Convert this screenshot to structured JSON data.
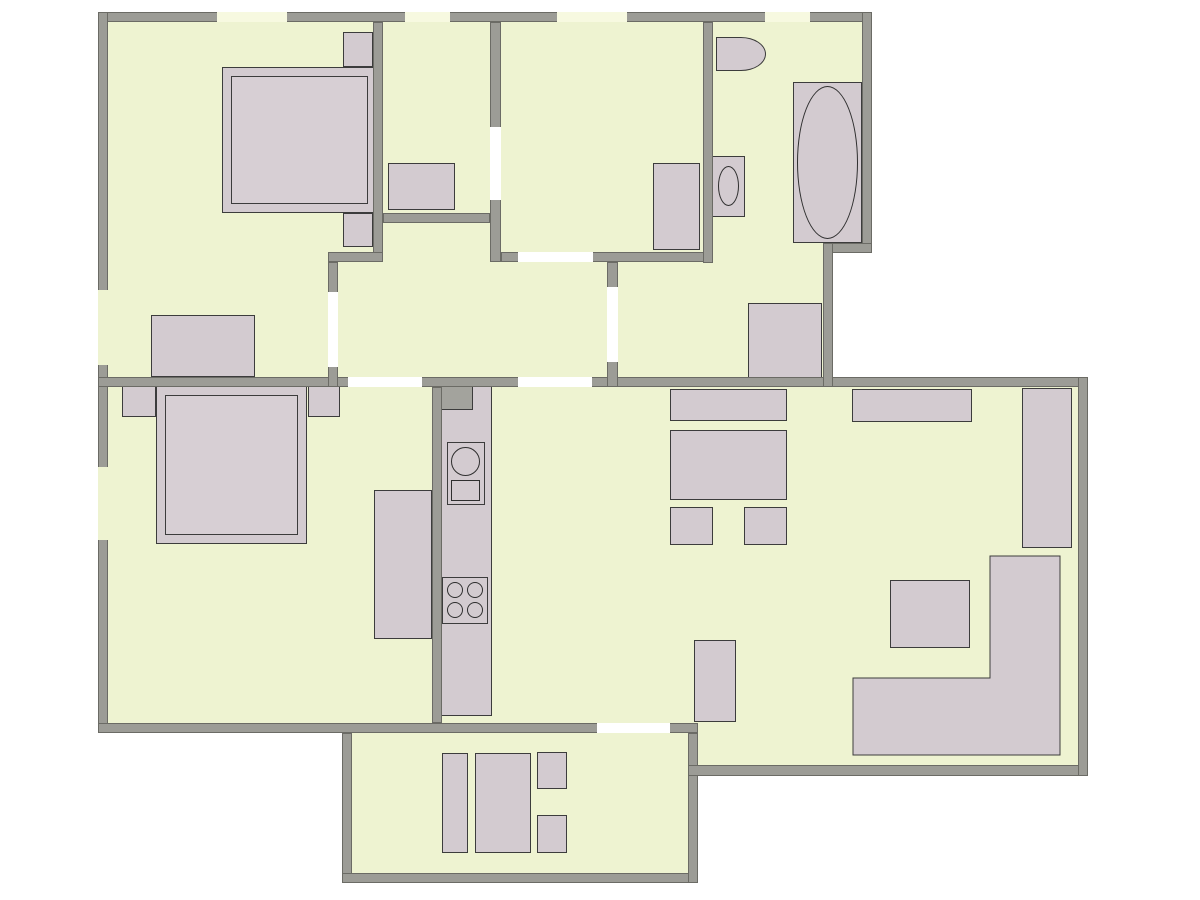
{
  "title": "apartment-floor-plan",
  "canvas": {
    "width": 1200,
    "height": 900
  },
  "colors": {
    "background": "#ffffff",
    "floor": "#eef3d1",
    "wall": "#9c9c96",
    "wall_edge": "#6b6b65",
    "furniture": "#d3cbd0",
    "bed_inner": "#d7cfd4",
    "shaft": "#a3a39d",
    "furniture_edge": "#3c3c3c",
    "fixture_line": "#2f2f2f",
    "window": "#f7f9e0",
    "door": "#ffffff"
  },
  "rooms": [
    {
      "name": "bedroom-top-left",
      "x": 108,
      "y": 22,
      "w": 265,
      "h": 355
    },
    {
      "name": "walk-in-closet",
      "x": 383,
      "y": 22,
      "w": 107,
      "h": 191
    },
    {
      "name": "middle-room",
      "x": 501,
      "y": 22,
      "w": 202,
      "h": 230
    },
    {
      "name": "bathroom",
      "x": 713,
      "y": 22,
      "w": 149,
      "h": 221
    },
    {
      "name": "hallway",
      "x": 338,
      "y": 223,
      "w": 269,
      "h": 154
    },
    {
      "name": "bathroom-corridor",
      "x": 618,
      "y": 263,
      "w": 205,
      "h": 114
    },
    {
      "name": "bedroom-bottom-left",
      "x": 108,
      "y": 387,
      "w": 324,
      "h": 336
    },
    {
      "name": "kitchen-strip",
      "x": 442,
      "y": 387,
      "w": 55,
      "h": 336
    },
    {
      "name": "living-dining-room",
      "x": 497,
      "y": 387,
      "w": 581,
      "h": 378
    },
    {
      "name": "balcony",
      "x": 352,
      "y": 733,
      "w": 336,
      "h": 140
    }
  ],
  "sofa": {
    "points": "990,556 1060,556 1060,755 853,755 853,678 990,678"
  },
  "layers": [
    {
      "name": "floors",
      "z": 0,
      "fill": "floor",
      "items": [
        {
          "name": "floor-top-band",
          "x": 108,
          "y": 22,
          "w": 754,
          "h": 221
        },
        {
          "name": "floor-mid-band",
          "x": 108,
          "y": 243,
          "w": 715,
          "h": 134
        },
        {
          "name": "floor-main",
          "x": 108,
          "y": 387,
          "w": 970,
          "h": 336
        },
        {
          "name": "floor-living-south",
          "x": 698,
          "y": 723,
          "w": 380,
          "h": 42
        },
        {
          "name": "floor-balcony",
          "x": 352,
          "y": 733,
          "w": 336,
          "h": 140
        }
      ]
    },
    {
      "name": "furniture",
      "z": 2,
      "fill": "furniture",
      "stroke": "furniture_edge",
      "items": [
        {
          "name": "bed-frame",
          "x": 222,
          "y": 67,
          "w": 155,
          "h": 146
        },
        {
          "name": "bed-mattress",
          "x": 231,
          "y": 76,
          "w": 137,
          "h": 128,
          "fill": "bed_inner"
        },
        {
          "name": "nightstand",
          "x": 343,
          "y": 32,
          "w": 30,
          "h": 35
        },
        {
          "name": "nightstand",
          "x": 343,
          "y": 213,
          "w": 30,
          "h": 34
        },
        {
          "name": "dresser",
          "x": 151,
          "y": 315,
          "w": 104,
          "h": 62
        },
        {
          "name": "closet-dresser",
          "x": 388,
          "y": 163,
          "w": 67,
          "h": 47
        },
        {
          "name": "wardrobe",
          "x": 653,
          "y": 163,
          "w": 47,
          "h": 87
        },
        {
          "name": "hall-wardrobe",
          "x": 748,
          "y": 303,
          "w": 74,
          "h": 75
        },
        {
          "name": "toilet",
          "x": 716,
          "y": 37,
          "w": 50,
          "h": 34,
          "radius": "0 50% 50% 0"
        },
        {
          "name": "bathroom-sink",
          "x": 712,
          "y": 156,
          "w": 33,
          "h": 61
        },
        {
          "name": "sink-basin-oval",
          "x": 718,
          "y": 166,
          "w": 21,
          "h": 40,
          "shape": "ellipse",
          "fill": "none",
          "stroke": "fixture_line"
        },
        {
          "name": "bathtub",
          "x": 793,
          "y": 82,
          "w": 69,
          "h": 161
        },
        {
          "name": "bathtub-basin-oval",
          "x": 797,
          "y": 86,
          "w": 61,
          "h": 153,
          "shape": "ellipse",
          "fill": "none",
          "stroke": "fixture_line"
        },
        {
          "name": "bed-frame",
          "x": 156,
          "y": 386,
          "w": 151,
          "h": 158
        },
        {
          "name": "bed-mattress",
          "x": 165,
          "y": 395,
          "w": 133,
          "h": 140,
          "fill": "bed_inner"
        },
        {
          "name": "nightstand",
          "x": 122,
          "y": 386,
          "w": 34,
          "h": 31
        },
        {
          "name": "nightstand",
          "x": 308,
          "y": 386,
          "w": 32,
          "h": 31
        },
        {
          "name": "desk",
          "x": 374,
          "y": 490,
          "w": 58,
          "h": 149
        },
        {
          "name": "kitchen-counter",
          "x": 440,
          "y": 384,
          "w": 52,
          "h": 332
        },
        {
          "name": "kitchen-shaft",
          "x": 440,
          "y": 384,
          "w": 33,
          "h": 26,
          "fill": "shaft"
        },
        {
          "name": "kitchen-sink-unit",
          "x": 447,
          "y": 442,
          "w": 38,
          "h": 63
        },
        {
          "name": "kitchen-sink-basin",
          "x": 451,
          "y": 447,
          "w": 29,
          "h": 29,
          "shape": "ellipse",
          "fill": "none",
          "stroke": "fixture_line"
        },
        {
          "name": "kitchen-drainer",
          "x": 451,
          "y": 480,
          "w": 29,
          "h": 21,
          "fill": "none",
          "stroke": "fixture_line",
          "hatch": true
        },
        {
          "name": "stove",
          "x": 442,
          "y": 577,
          "w": 46,
          "h": 47
        },
        {
          "name": "burner",
          "x": 447,
          "y": 582,
          "w": 16,
          "h": 16,
          "shape": "ellipse",
          "fill": "none",
          "stroke": "fixture_line"
        },
        {
          "name": "burner",
          "x": 467,
          "y": 582,
          "w": 16,
          "h": 16,
          "shape": "ellipse",
          "fill": "none",
          "stroke": "fixture_line"
        },
        {
          "name": "burner",
          "x": 447,
          "y": 602,
          "w": 16,
          "h": 16,
          "shape": "ellipse",
          "fill": "none",
          "stroke": "fixture_line"
        },
        {
          "name": "burner",
          "x": 467,
          "y": 602,
          "w": 16,
          "h": 16,
          "shape": "ellipse",
          "fill": "none",
          "stroke": "fixture_line"
        },
        {
          "name": "sideboard",
          "x": 670,
          "y": 389,
          "w": 117,
          "h": 32
        },
        {
          "name": "dining-table",
          "x": 670,
          "y": 430,
          "w": 117,
          "h": 70
        },
        {
          "name": "chair",
          "x": 670,
          "y": 507,
          "w": 43,
          "h": 38
        },
        {
          "name": "chair",
          "x": 744,
          "y": 507,
          "w": 43,
          "h": 38
        },
        {
          "name": "sideboard",
          "x": 852,
          "y": 389,
          "w": 120,
          "h": 33
        },
        {
          "name": "tall-wardrobe",
          "x": 1022,
          "y": 388,
          "w": 50,
          "h": 160
        },
        {
          "name": "coffee-table",
          "x": 890,
          "y": 580,
          "w": 80,
          "h": 68
        },
        {
          "name": "side-cabinet",
          "x": 694,
          "y": 640,
          "w": 42,
          "h": 82
        },
        {
          "name": "balcony-bench",
          "x": 442,
          "y": 753,
          "w": 26,
          "h": 100
        },
        {
          "name": "balcony-table",
          "x": 475,
          "y": 753,
          "w": 56,
          "h": 100
        },
        {
          "name": "balcony-chair",
          "x": 537,
          "y": 752,
          "w": 30,
          "h": 37
        },
        {
          "name": "balcony-chair",
          "x": 537,
          "y": 815,
          "w": 30,
          "h": 38
        }
      ]
    },
    {
      "name": "walls",
      "z": 3,
      "fill": "wall",
      "stroke": "wall_edge",
      "items": [
        {
          "name": "wall-top-exterior",
          "x": 98,
          "y": 12,
          "w": 774,
          "h": 10
        },
        {
          "name": "wall-left-exterior",
          "x": 98,
          "y": 12,
          "w": 10,
          "h": 721
        },
        {
          "name": "wall-middle-horizontal",
          "x": 98,
          "y": 377,
          "w": 990,
          "h": 10
        },
        {
          "name": "wall-bottom-exterior",
          "x": 98,
          "y": 723,
          "w": 600,
          "h": 10
        },
        {
          "name": "wall-bedroom1-right",
          "x": 373,
          "y": 22,
          "w": 10,
          "h": 240
        },
        {
          "name": "wall-bedroom1-step",
          "x": 328,
          "y": 252,
          "w": 55,
          "h": 10
        },
        {
          "name": "wall-bedroom1-door-wall",
          "x": 328,
          "y": 262,
          "w": 10,
          "h": 125
        },
        {
          "name": "wall-closet-bottom",
          "x": 383,
          "y": 213,
          "w": 107,
          "h": 10
        },
        {
          "name": "wall-closet-right",
          "x": 490,
          "y": 22,
          "w": 11,
          "h": 240
        },
        {
          "name": "wall-middleroom-bottom",
          "x": 501,
          "y": 252,
          "w": 212,
          "h": 10
        },
        {
          "name": "wall-middleroom-bath",
          "x": 703,
          "y": 22,
          "w": 10,
          "h": 241
        },
        {
          "name": "wall-hallway-right",
          "x": 607,
          "y": 262,
          "w": 11,
          "h": 125
        },
        {
          "name": "wall-kitchen",
          "x": 432,
          "y": 387,
          "w": 10,
          "h": 336
        },
        {
          "name": "wall-balcony-left",
          "x": 342,
          "y": 733,
          "w": 10,
          "h": 150
        },
        {
          "name": "wall-balcony-bottom",
          "x": 342,
          "y": 873,
          "w": 356,
          "h": 10
        },
        {
          "name": "wall-balcony-right",
          "x": 688,
          "y": 733,
          "w": 10,
          "h": 150
        },
        {
          "name": "wall-living-bottom",
          "x": 688,
          "y": 765,
          "w": 400,
          "h": 11
        },
        {
          "name": "wall-living-right",
          "x": 1078,
          "y": 377,
          "w": 10,
          "h": 399
        },
        {
          "name": "wall-bathroom-right",
          "x": 862,
          "y": 12,
          "w": 10,
          "h": 241
        },
        {
          "name": "wall-bathroom-step",
          "x": 823,
          "y": 243,
          "w": 49,
          "h": 10
        },
        {
          "name": "wall-corridor-right",
          "x": 823,
          "y": 243,
          "w": 10,
          "h": 144
        }
      ]
    },
    {
      "name": "openings",
      "z": 4,
      "fill": "door",
      "items": [
        {
          "name": "window-opening",
          "x": 217,
          "y": 12,
          "w": 70,
          "h": 10,
          "fill": "window"
        },
        {
          "name": "window-opening",
          "x": 405,
          "y": 12,
          "w": 45,
          "h": 10,
          "fill": "window"
        },
        {
          "name": "window-opening",
          "x": 557,
          "y": 12,
          "w": 70,
          "h": 10,
          "fill": "window"
        },
        {
          "name": "window-opening",
          "x": 765,
          "y": 12,
          "w": 45,
          "h": 10,
          "fill": "window"
        },
        {
          "name": "window-opening",
          "x": 98,
          "y": 290,
          "w": 10,
          "h": 75,
          "fill": "floor"
        },
        {
          "name": "window-opening",
          "x": 98,
          "y": 467,
          "w": 10,
          "h": 73,
          "fill": "floor"
        },
        {
          "name": "door-opening-bedroom1",
          "x": 328,
          "y": 292,
          "w": 10,
          "h": 75
        },
        {
          "name": "door-opening-bedroom2",
          "x": 348,
          "y": 377,
          "w": 74,
          "h": 10
        },
        {
          "name": "door-opening-dining",
          "x": 518,
          "y": 377,
          "w": 74,
          "h": 10
        },
        {
          "name": "door-opening-middleroom",
          "x": 518,
          "y": 252,
          "w": 75,
          "h": 10
        },
        {
          "name": "door-opening-closet",
          "x": 490,
          "y": 127,
          "w": 11,
          "h": 73
        },
        {
          "name": "door-opening-corridor",
          "x": 607,
          "y": 287,
          "w": 11,
          "h": 75
        },
        {
          "name": "door-opening-balcony",
          "x": 597,
          "y": 723,
          "w": 73,
          "h": 10
        }
      ]
    }
  ]
}
